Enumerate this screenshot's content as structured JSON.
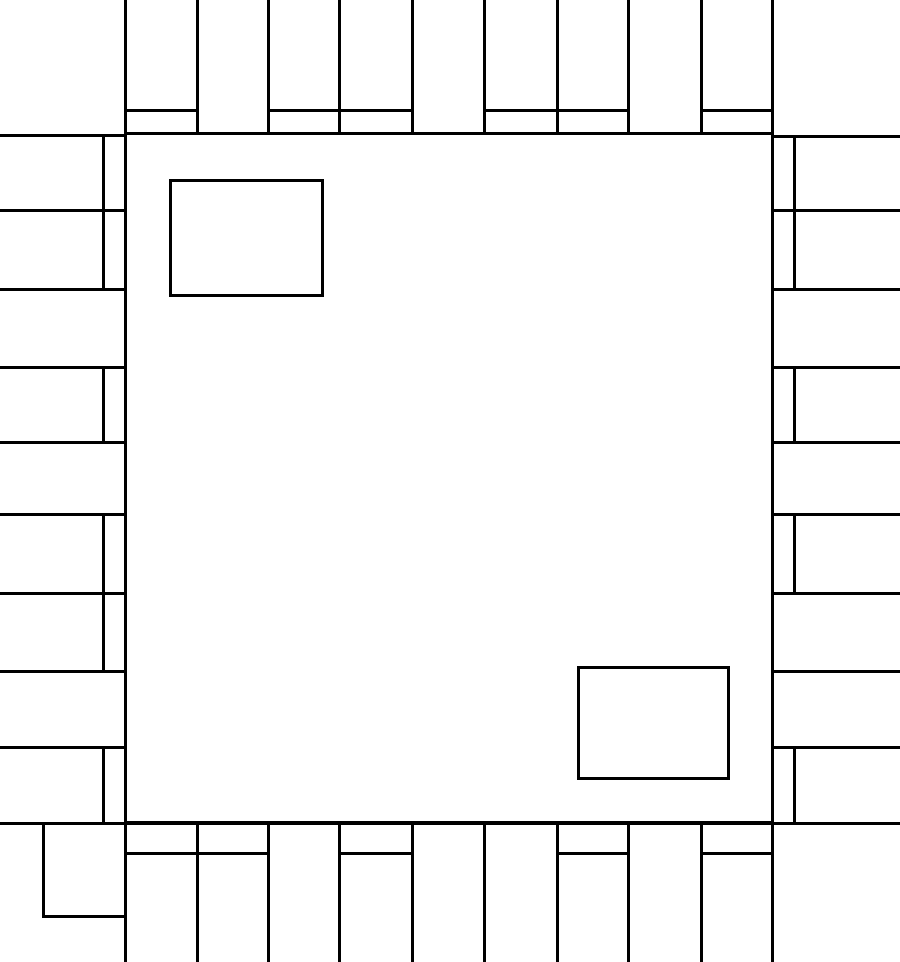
{
  "diagram": {
    "title": "ic-package-footprint-outline",
    "canvas": {
      "width": 900,
      "height": 962,
      "background_color": "#ffffff"
    },
    "stroke": {
      "color": "#000000",
      "width": 3
    },
    "package_body": {
      "x1": 125,
      "y1": 133,
      "x2": 772,
      "y2": 822
    },
    "full_width_line_y": 823,
    "top_pins": {
      "boundaries_x": [
        125,
        197,
        268,
        339,
        412,
        484,
        557,
        628,
        701,
        772
      ],
      "outer_y": 0,
      "body_edge_y": 133,
      "foot_line_y": 110,
      "foot_columns": [
        0,
        2,
        3,
        5,
        6,
        8
      ]
    },
    "bottom_pins": {
      "boundaries_x": [
        125,
        197,
        268,
        339,
        412,
        484,
        557,
        628,
        701,
        772
      ],
      "outer_y": 962,
      "body_edge_y": 823,
      "foot_line_y": 853,
      "foot_columns": [
        0,
        1,
        3,
        6,
        8
      ]
    },
    "left_pins": {
      "boundaries_y": [
        135,
        210,
        289,
        367,
        442,
        514,
        593,
        671,
        747,
        823
      ],
      "outer_x": 0,
      "body_edge_x": 125,
      "foot_line_x": 103,
      "foot_rows": [
        0,
        1,
        3,
        5,
        6,
        8
      ]
    },
    "right_pins": {
      "boundaries_y": [
        136,
        210,
        289,
        367,
        442,
        514,
        593,
        671,
        747,
        823
      ],
      "outer_x": 900,
      "body_edge_x": 772,
      "foot_line_x": 794,
      "foot_rows": [
        0,
        1,
        3,
        5,
        8
      ]
    },
    "corner_pad": {
      "x1": 43,
      "y1": 823,
      "x2": 125,
      "y2": 916
    },
    "inner_marks": [
      {
        "name": "index-mark-top-left",
        "x1": 170,
        "y1": 180,
        "x2": 322,
        "y2": 295
      },
      {
        "name": "index-mark-bottom-right",
        "x1": 578,
        "y1": 667,
        "x2": 728,
        "y2": 778
      }
    ]
  }
}
